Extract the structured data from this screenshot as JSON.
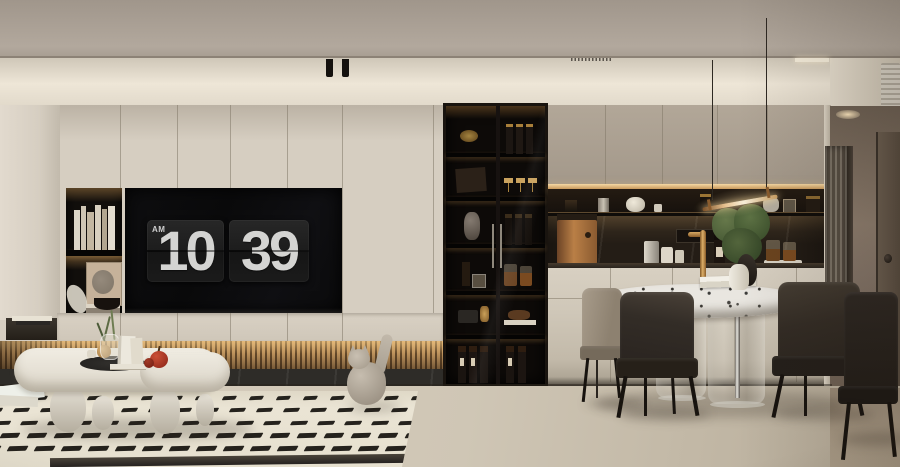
{
  "scene": {
    "description": "Photorealistic render of a modern beige living-dining room: TV wall with flip clock, backlit wood-slat media bench, glass display cabinet, dark marble kitchen backsplash, round marble dining table with glass base, patterned cream rug, cat sculpture"
  },
  "clock": {
    "meridiem": "AM",
    "hour": "10",
    "minute": "39"
  },
  "palette": {
    "wall": "#d6cec1",
    "ceiling": "#a89e93",
    "cove": "#e9e1d2",
    "tv_black": "#0c0b0b",
    "digit": "#d3d3d3",
    "wood_slat": "#b98a55",
    "backsplash": "#241d16",
    "floor": "#cdc4b3",
    "rug": "#eae4d4",
    "dash": "#16130f",
    "accent_brass": "#c49256"
  },
  "rug_pattern": {
    "rows": 5,
    "cols": 18,
    "col_step": 27,
    "row_step": 12.4,
    "row_shift": 7,
    "dash_w": 13,
    "dash_h": 3.6
  }
}
